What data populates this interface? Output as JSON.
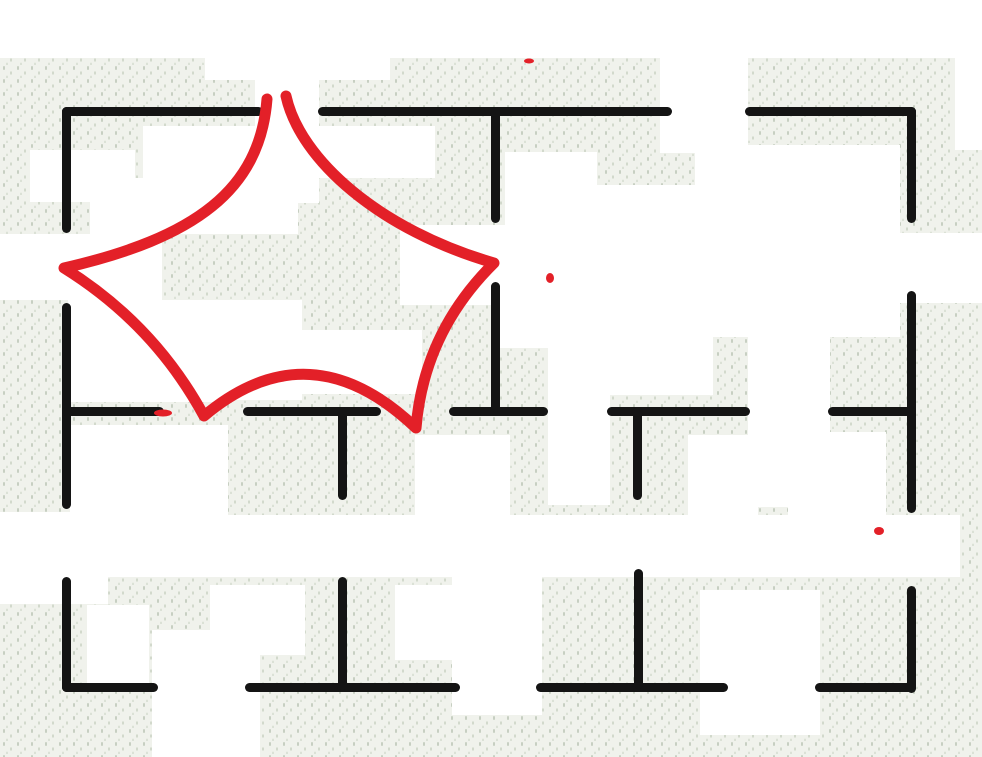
{
  "scene": {
    "description": "Hand-sketched apartment floor plan on speckled fabric-like paper with a red hand-drawn five-point concave star annotation over the upper-left rooms",
    "width": 982,
    "height": 757,
    "background": {
      "base_color": "#f0f2ec",
      "speckle_colors": [
        "#c7cfc2",
        "#d2d9cc",
        "#dbe1d6"
      ],
      "patch_color": "#ffffff"
    }
  },
  "floorplan": {
    "wall_color": "#141414",
    "wall_thickness": 9,
    "walls": [
      {
        "x": 62,
        "y": 107,
        "w": 201,
        "h": 9
      },
      {
        "x": 318,
        "y": 107,
        "w": 354,
        "h": 9
      },
      {
        "x": 745,
        "y": 107,
        "w": 171,
        "h": 9
      },
      {
        "x": 62,
        "y": 107,
        "w": 9,
        "h": 126
      },
      {
        "x": 62,
        "y": 303,
        "w": 9,
        "h": 206
      },
      {
        "x": 62,
        "y": 577,
        "w": 9,
        "h": 115
      },
      {
        "x": 907,
        "y": 107,
        "w": 9,
        "h": 116
      },
      {
        "x": 907,
        "y": 291,
        "w": 9,
        "h": 222
      },
      {
        "x": 907,
        "y": 586,
        "w": 9,
        "h": 107
      },
      {
        "x": 62,
        "y": 683,
        "w": 96,
        "h": 9
      },
      {
        "x": 245,
        "y": 683,
        "w": 215,
        "h": 9
      },
      {
        "x": 536,
        "y": 683,
        "w": 192,
        "h": 9
      },
      {
        "x": 815,
        "y": 683,
        "w": 101,
        "h": 9
      },
      {
        "x": 62,
        "y": 407,
        "w": 102,
        "h": 9
      },
      {
        "x": 243,
        "y": 407,
        "w": 138,
        "h": 9
      },
      {
        "x": 449,
        "y": 407,
        "w": 99,
        "h": 9
      },
      {
        "x": 607,
        "y": 407,
        "w": 143,
        "h": 9
      },
      {
        "x": 828,
        "y": 407,
        "w": 88,
        "h": 9
      },
      {
        "x": 491,
        "y": 107,
        "w": 9,
        "h": 116
      },
      {
        "x": 491,
        "y": 282,
        "w": 9,
        "h": 130
      },
      {
        "x": 338,
        "y": 407,
        "w": 9,
        "h": 93
      },
      {
        "x": 633,
        "y": 407,
        "w": 9,
        "h": 93
      },
      {
        "x": 338,
        "y": 577,
        "w": 9,
        "h": 113
      },
      {
        "x": 634,
        "y": 569,
        "w": 9,
        "h": 120
      }
    ]
  },
  "white_patches": [
    {
      "x": 0,
      "y": 0,
      "w": 982,
      "h": 58
    },
    {
      "x": 205,
      "y": 58,
      "w": 185,
      "h": 22
    },
    {
      "x": 255,
      "y": 78,
      "w": 64,
      "h": 125
    },
    {
      "x": 143,
      "y": 126,
      "w": 292,
      "h": 52
    },
    {
      "x": 30,
      "y": 150,
      "w": 105,
      "h": 52
    },
    {
      "x": 90,
      "y": 178,
      "w": 208,
      "h": 56
    },
    {
      "x": 0,
      "y": 234,
      "w": 162,
      "h": 66
    },
    {
      "x": 400,
      "y": 225,
      "w": 158,
      "h": 80
    },
    {
      "x": 500,
      "y": 230,
      "w": 90,
      "h": 118
    },
    {
      "x": 548,
      "y": 295,
      "w": 165,
      "h": 100
    },
    {
      "x": 68,
      "y": 300,
      "w": 165,
      "h": 102
    },
    {
      "x": 230,
      "y": 300,
      "w": 72,
      "h": 100
    },
    {
      "x": 296,
      "y": 330,
      "w": 126,
      "h": 64
    },
    {
      "x": 505,
      "y": 152,
      "w": 92,
      "h": 185
    },
    {
      "x": 660,
      "y": 58,
      "w": 88,
      "h": 95
    },
    {
      "x": 695,
      "y": 145,
      "w": 205,
      "h": 192
    },
    {
      "x": 595,
      "y": 185,
      "w": 100,
      "h": 150
    },
    {
      "x": 900,
      "y": 233,
      "w": 82,
      "h": 70
    },
    {
      "x": 955,
      "y": 0,
      "w": 27,
      "h": 150
    },
    {
      "x": 748,
      "y": 335,
      "w": 82,
      "h": 172
    },
    {
      "x": 548,
      "y": 390,
      "w": 62,
      "h": 115
    },
    {
      "x": 688,
      "y": 435,
      "w": 70,
      "h": 85
    },
    {
      "x": 788,
      "y": 432,
      "w": 98,
      "h": 85
    },
    {
      "x": 415,
      "y": 435,
      "w": 95,
      "h": 85
    },
    {
      "x": 70,
      "y": 425,
      "w": 158,
      "h": 148
    },
    {
      "x": 0,
      "y": 512,
      "w": 108,
      "h": 92
    },
    {
      "x": 20,
      "y": 515,
      "w": 940,
      "h": 62
    },
    {
      "x": 452,
      "y": 565,
      "w": 90,
      "h": 150
    },
    {
      "x": 700,
      "y": 590,
      "w": 120,
      "h": 145
    },
    {
      "x": 152,
      "y": 630,
      "w": 108,
      "h": 127
    },
    {
      "x": 210,
      "y": 585,
      "w": 95,
      "h": 70
    },
    {
      "x": 395,
      "y": 585,
      "w": 145,
      "h": 75
    },
    {
      "x": 87,
      "y": 605,
      "w": 62,
      "h": 85
    }
  ],
  "annotation": {
    "shape": "concave five-point star drawn by hand in red marker",
    "color": "#e32028",
    "stroke_width": 11,
    "path": "M 286 96 C 300 160 380 230 494 263 Q 424 332 416 428 Q 310 327 204 416 Q 154 324 64 268 C 195 238 260 190 267 99",
    "specks": [
      {
        "x": 529,
        "y": 61,
        "rx": 5,
        "ry": 2.5
      },
      {
        "x": 550,
        "y": 278,
        "rx": 4,
        "ry": 5
      },
      {
        "x": 163,
        "y": 413,
        "rx": 9,
        "ry": 3.5
      },
      {
        "x": 879,
        "y": 531,
        "rx": 5,
        "ry": 4
      }
    ]
  }
}
